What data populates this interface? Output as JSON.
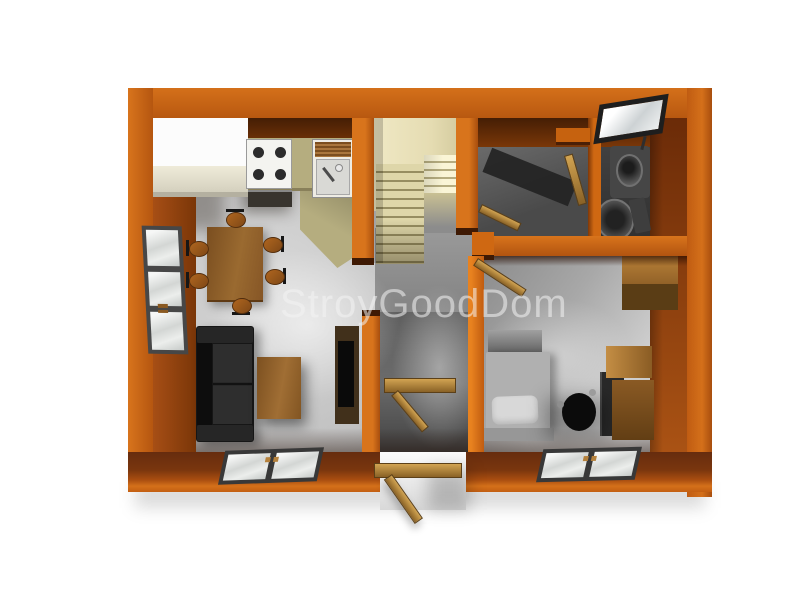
{
  "watermark": {
    "text": "StroyGoodDom"
  },
  "scene": {
    "type": "3d-floor-plan-render",
    "view": "top-down perspective render of a single-storey house floor plan on white background",
    "rooms": [
      "kitchen",
      "dining-area",
      "living-room",
      "staircase",
      "hallway",
      "bathroom",
      "bedroom",
      "entrance-vestibule"
    ],
    "objects": [
      "fridge",
      "stove",
      "oven",
      "kitchen-sink",
      "kitchen-counter",
      "dining-table",
      "dining-chairs-x6",
      "sofa",
      "coffee-table",
      "tv-stand",
      "staircase-landing",
      "stair-flight",
      "washbasin",
      "toilet",
      "bathroom-window",
      "bed",
      "pillow",
      "office-chair",
      "desk",
      "wardrobes-x3",
      "left-wall-window",
      "living-room-window",
      "bedroom-window",
      "entrance-door-open",
      "interior-doors-open",
      "wooden-beams"
    ]
  },
  "colors": {
    "wall_orange": "#d4701a",
    "wall_orange_dark": "#a84e0e",
    "wall_shadow_brown": "#3f1a04",
    "floor_gray": "#c2c2c2",
    "floor_dark": "#565656",
    "stair_cream": "#e5dcb2",
    "counter_khaki": "#b5ad7f",
    "wood_light": "#d2a452",
    "wood_dark": "#8a6226",
    "furniture_brown": "#9a6a30",
    "sofa_black": "#161616",
    "fixture_gray": "#464646",
    "watermark_white": "#f4f4f4"
  }
}
